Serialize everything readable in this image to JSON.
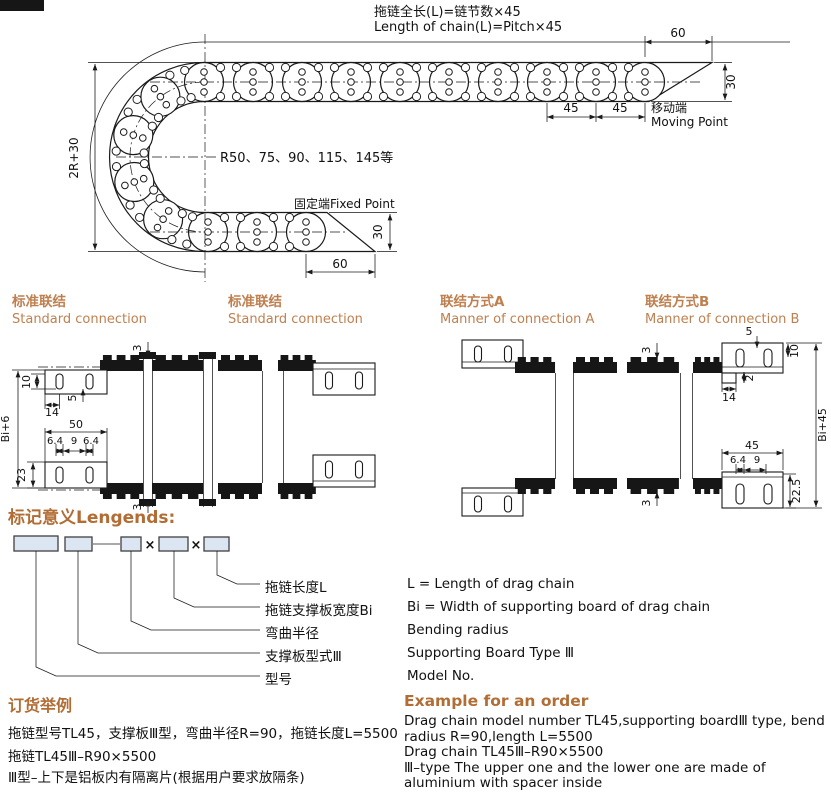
{
  "colors": {
    "accent": "#b26d35",
    "accent_light": "#bf8050",
    "ink": "#1a1a1a",
    "box_fill": "#dce6f2"
  },
  "top_drawing": {
    "title_cn": "拖链全长(L)=链节数×45",
    "title_en": "Length of chain(L)=Pitch×45",
    "dim_top_60": "60",
    "dim_right_30": "30",
    "dim_pitch_a": "45",
    "dim_pitch_b": "45",
    "moving_point_cn": "移动端",
    "moving_point_en": "Moving Point",
    "radius_note": "R50、75、90、115、145等",
    "fixed_point_label": "固定端Fixed Point",
    "dim_height": "2R+30",
    "dim_bottom_30": "30",
    "dim_bottom_60": "60"
  },
  "section_headings": [
    {
      "cn": "标准联结",
      "en": "Standard connection"
    },
    {
      "cn": "标准联结",
      "en": "Standard connection"
    },
    {
      "cn": "联结方式A",
      "en": "Manner of connection A"
    },
    {
      "cn": "联结方式B",
      "en": "Manner of connection B"
    }
  ],
  "cross_section_1": {
    "dim_plate_3_top": "3",
    "dim_10": "10",
    "dim_14": "14",
    "dim_5": "5",
    "dim_width": "Bi+6",
    "dim_50": "50",
    "dim_64_left": "6.4",
    "dim_9": "9",
    "dim_64_right": "6.4",
    "dim_23": "23",
    "dim_plate_3_bottom": "3"
  },
  "cross_section_4": {
    "dim_plate_3_top": "3",
    "dim_5": "5",
    "dim_10": "10",
    "dim_2": "2",
    "dim_14": "14",
    "dim_width": "Bi+45",
    "dim_45": "45",
    "dim_64": "6.4",
    "dim_9": "9",
    "dim_225": "22.5",
    "dim_plate_3_bottom": "3"
  },
  "legends": {
    "heading": "标记意义Lengends:",
    "times_1": "×",
    "times_2": "×",
    "items": [
      {
        "cn": "拖链长度L",
        "en": "L = Length of drag chain"
      },
      {
        "cn": "拖链支撑板宽度Bi",
        "en": "Bi = Width of supporting board of drag chain"
      },
      {
        "cn": "弯曲半径",
        "en": "Bending radius"
      },
      {
        "cn": "支撑板型式Ⅲ",
        "en": "Supporting Board Type Ⅲ"
      },
      {
        "cn": "型号",
        "en": "Model No."
      }
    ]
  },
  "order_example": {
    "heading_cn": "订货举例",
    "heading_en": "Example for an order",
    "cn_lines": [
      "拖链型号TL45，支撑板Ⅲ型，弯曲半径R=90，拖链长度L=5500",
      "拖链TL45Ⅲ–R90×5500",
      "Ⅲ型–上下是铝板内有隔离片(根据用户要求放隔条)"
    ],
    "en_lines": [
      "Drag chain model number TL45,supporting boardⅢ type, bend radius R=90,length L=5500",
      "Drag chain TL45Ⅲ–R90×5500",
      "Ⅲ–type The upper one and the lower one are made of aluminium with spacer inside"
    ]
  }
}
